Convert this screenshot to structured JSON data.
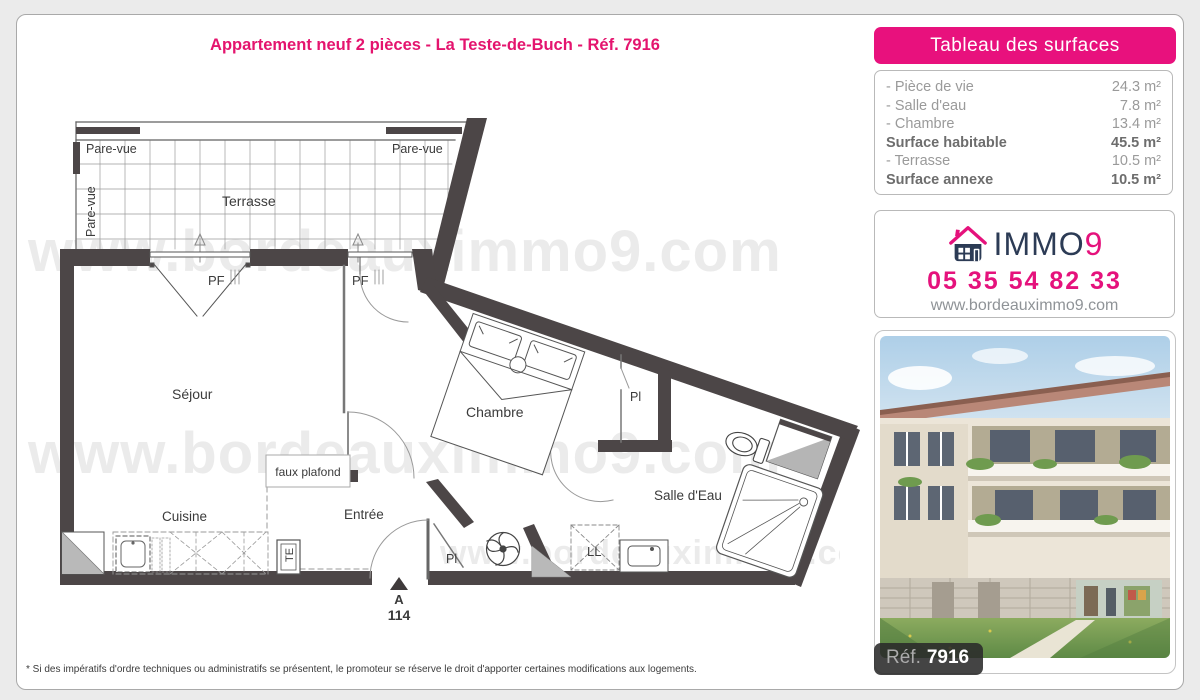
{
  "page": {
    "title": "Appartement neuf 2 pièces - La Teste-de-Buch - Réf. 7916",
    "footnote": "* Si des impératifs d'ordre techniques ou administratifs se présentent, le promoteur se réserve le droit d'apporter certaines modifications aux logements."
  },
  "watermark": {
    "text": "www.bordeauximmo9.com"
  },
  "plan": {
    "labels": {
      "terrasse": "Terrasse",
      "sejour": "Séjour",
      "chambre": "Chambre",
      "salle_eau": "Salle d'Eau",
      "cuisine": "Cuisine",
      "entree": "Entrée",
      "faux_plafond": "faux plafond",
      "pare_vue": "Pare-vue",
      "pf": "PF",
      "pl": "Pl",
      "ll": "LL",
      "te": "TE",
      "lot_letter": "A",
      "lot_number": "114"
    }
  },
  "surfaces": {
    "header": "Tableau des surfaces",
    "rows": [
      {
        "label": "- Pièce de vie",
        "value": "24.3 m²"
      },
      {
        "label": "- Salle d'eau",
        "value": "7.8 m²"
      },
      {
        "label": "- Chambre",
        "value": "13.4 m²"
      },
      {
        "label": "Surface habitable",
        "value": "45.5 m²"
      },
      {
        "label": "- Terrasse",
        "value": "10.5 m²"
      },
      {
        "label": "Surface annexe",
        "value": "10.5 m²"
      }
    ]
  },
  "contact": {
    "brand_immo": "IMMO",
    "brand_9": "9",
    "phone": "05 35 54 82 33",
    "website": "www.bordeauximmo9.com"
  },
  "photo": {
    "badge_label": "Réf.",
    "badge_number": "7916"
  },
  "colors": {
    "pink": "#e5127c",
    "navy": "#2c3b55",
    "wall": "#4c4647"
  }
}
